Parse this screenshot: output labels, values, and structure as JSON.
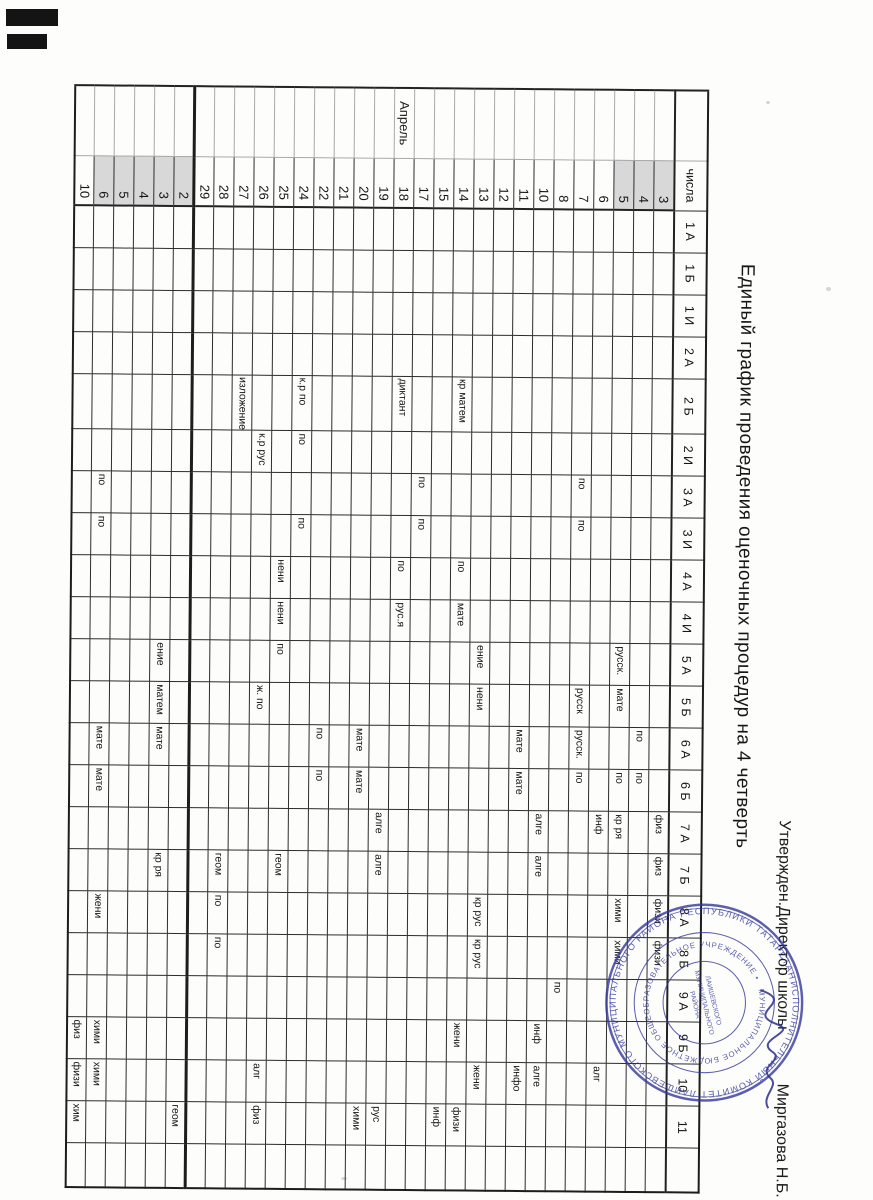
{
  "document": {
    "approval_prefix": "Утвержден.Директор школы",
    "approval_name": "Миргазова Н.Б.",
    "title": "Единый график проведения  оценочных процедур  на 4 четверть"
  },
  "table": {
    "date_header": "числа",
    "month_april": "Апрель",
    "classes": [
      {
        "label": "1 А",
        "key": "1A"
      },
      {
        "label": "1 Б",
        "key": "1B"
      },
      {
        "label": "1 И",
        "key": "1I"
      },
      {
        "label": "2 А",
        "key": "2A"
      },
      {
        "label": "2 Б",
        "key": "2B"
      },
      {
        "label": "2 И",
        "key": "2I"
      },
      {
        "label": "3 А",
        "key": "3A"
      },
      {
        "label": "3 И",
        "key": "3I"
      },
      {
        "label": "4 А",
        "key": "4A"
      },
      {
        "label": "4 И",
        "key": "4I"
      },
      {
        "label": "5 А",
        "key": "5A"
      },
      {
        "label": "5 Б",
        "key": "5B"
      },
      {
        "label": "6 А",
        "key": "6A"
      },
      {
        "label": "6 Б",
        "key": "6B"
      },
      {
        "label": "7 А",
        "key": "7A"
      },
      {
        "label": "7 Б",
        "key": "7B"
      },
      {
        "label": "8 А",
        "key": "8A"
      },
      {
        "label": "8 Б",
        "key": "8B"
      },
      {
        "label": "9 А",
        "key": "9A"
      },
      {
        "label": "9 Б",
        "key": "9B"
      },
      {
        "label": "10",
        "key": "10"
      },
      {
        "label": "11",
        "key": "11"
      },
      {
        "label": "",
        "key": "x"
      }
    ],
    "rows": [
      {
        "date": "3",
        "shaded": true,
        "cells": {
          "7A": "физ",
          "7B": "физ",
          "8A": "физи",
          "8B": "физи"
        }
      },
      {
        "date": "4",
        "shaded": true,
        "cells": {
          "6A": "по",
          "6B": "по"
        }
      },
      {
        "date": "5",
        "shaded": true,
        "cells": {
          "5A": "русск.",
          "5B": "мате",
          "6B": "по",
          "7A": "кр ря",
          "8A": "хими",
          "8B": "хими"
        }
      },
      {
        "date": "6",
        "cells": {
          "7A": "инф",
          "10": "алг"
        }
      },
      {
        "date": "7",
        "cells": {
          "3A": "по",
          "3I": "по",
          "5B": "русск",
          "6A": "русск.",
          "6B": "по"
        }
      },
      {
        "date": "8",
        "cells": {
          "9A": "по"
        }
      },
      {
        "date": "10",
        "cells": {
          "7A": "алге",
          "7B": "алге",
          "9B": "инф",
          "10": "алге"
        }
      },
      {
        "date": "11",
        "cells": {
          "6A": "мате",
          "6B": "мате",
          "10": "инфо"
        }
      },
      {
        "date": "12",
        "cells": {}
      },
      {
        "date": "13",
        "cells": {
          "5A": "ение",
          "5B": "нени",
          "8A": "кр рус",
          "8B": "кр рус",
          "10": "жени"
        }
      },
      {
        "date": "14",
        "cells": {
          "2B": "кр матем",
          "4A": "по",
          "4I": "мате",
          "9B": "жени",
          "11": "физи"
        }
      },
      {
        "date": "15",
        "cells": {
          "11": "инф"
        }
      },
      {
        "date": "17",
        "cells": {
          "3A": "по",
          "3I": "по"
        }
      },
      {
        "date": "18",
        "month": "Апрель",
        "cells": {
          "2B": "диктант",
          "4A": "по",
          "4I": "рус.я"
        }
      },
      {
        "date": "19",
        "cells": {
          "7A": "алге",
          "7B": "алге",
          "11": "рус"
        }
      },
      {
        "date": "20",
        "cells": {
          "6A": "мате",
          "6B": "мате",
          "11": "хими"
        }
      },
      {
        "date": "21",
        "cells": {}
      },
      {
        "date": "22",
        "cells": {
          "6A": "по",
          "6B": "по"
        }
      },
      {
        "date": "24",
        "cells": {
          "2B": "к.р по",
          "2I": "по",
          "3I": "по"
        }
      },
      {
        "date": "25",
        "cells": {
          "4A": "нени",
          "4I": "нени",
          "5A": "по",
          "7B": "геом"
        }
      },
      {
        "date": "26",
        "cells": {
          "2I": "к.р рус",
          "5B": "ж. по",
          "10": "алг",
          "11": "физ"
        }
      },
      {
        "date": "27",
        "cells": {
          "2B": "изложение"
        }
      },
      {
        "date": "28",
        "cells": {
          "7B": "геом",
          "8A": "по",
          "8B": "по"
        }
      },
      {
        "date": "29",
        "cells": {}
      },
      {
        "date": "2",
        "shaded": true,
        "sep": true,
        "cells": {
          "11": "геом"
        }
      },
      {
        "date": "3",
        "shaded": true,
        "cells": {
          "5A": "ение",
          "5B": "матем",
          "6A": "мате",
          "7B": "кр ря"
        }
      },
      {
        "date": "4",
        "shaded": true,
        "cells": {}
      },
      {
        "date": "5",
        "shaded": true,
        "cells": {}
      },
      {
        "date": "6",
        "shaded": true,
        "cells": {
          "3A": "по",
          "3I": "по",
          "6A": "мате",
          "6B": "мате",
          "8A": "жени",
          "9B": "хими",
          "10": "хими"
        }
      },
      {
        "date": "10",
        "cells": {
          "9B": "физ",
          "10": "физи",
          "11": "хим"
        }
      }
    ]
  },
  "stamp": {
    "outer_text": "ИСПОЛНИТЕЛЬНЫЙ КОМИТЕТ ЛАИШЕВСКОГО МУНИЦИПАЛЬНОГО РАЙОНА РЕСПУБЛИКИ ТАТАРСТАН •",
    "inner_text": "МУНИЦИПАЛЬНОЕ БЮДЖЕТНОЕ ОБЩЕОБРАЗОВАТЕЛЬНОЕ УЧРЕЖДЕНИЕ •",
    "center_lines": [
      "ЛАИШЕВСКОГО",
      "МУНИЦИПАЛЬНОГО",
      "РАЙОНА"
    ]
  },
  "colors": {
    "stamp_ink": "#34389b",
    "grid_line": "#2c2c2c",
    "shaded_cell": "#d8d8d8",
    "paper": "#fdfdfb"
  }
}
